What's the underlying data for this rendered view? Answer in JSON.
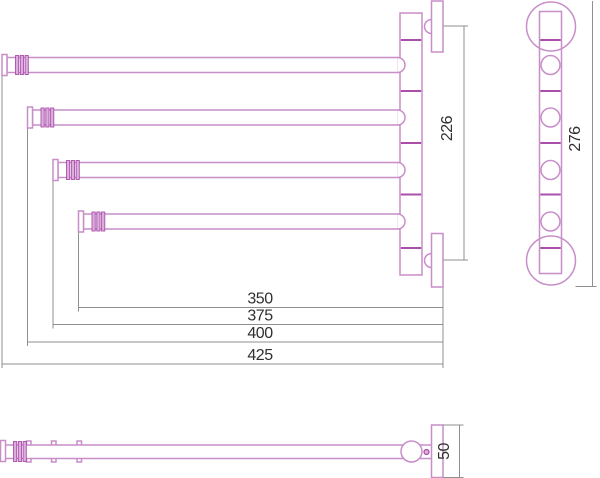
{
  "drawing_kind": "swivel-towel-rail-technical-drawing",
  "colors": {
    "outline": "#c88ec8",
    "outline_strong": "#a94fa9",
    "collar_fill": "#ddaedd",
    "dimension_line": "#8f8f8f",
    "text": "#303030",
    "background": "#ffffff"
  },
  "dimensions": {
    "arm_350": "350",
    "arm_375": "375",
    "arm_400": "400",
    "arm_425": "425",
    "bracket_spacing": "226",
    "side_height": "276",
    "bracket_width": "50"
  }
}
